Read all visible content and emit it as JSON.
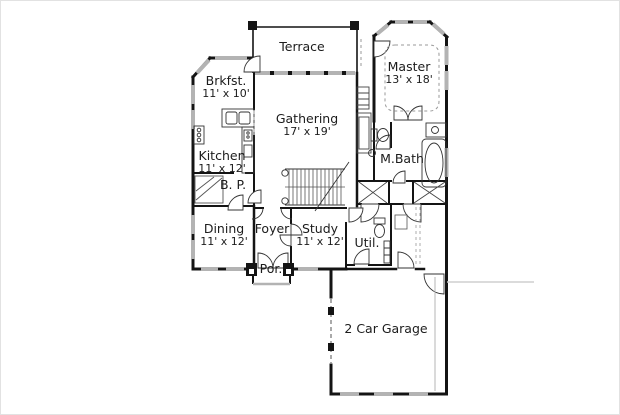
{
  "plan": {
    "type": "residential-floor-plan",
    "colors": {
      "wall": "#141414",
      "window": "#b3b3b3",
      "text": "#1c1c1c",
      "background": "#ffffff"
    }
  },
  "rooms": {
    "terrace": {
      "name": "Terrace"
    },
    "master": {
      "name": "Master",
      "dims": "13' x 18'"
    },
    "brkfst": {
      "name": "Brkfst.",
      "dims": "11' x 10'"
    },
    "gathering": {
      "name": "Gathering",
      "dims": "17' x 19'"
    },
    "kitchen": {
      "name": "Kitchen",
      "dims": "11' x 12'"
    },
    "butlers_pantry": {
      "name": "B. P."
    },
    "mbath": {
      "name": "M.Bath"
    },
    "dining": {
      "name": "Dining",
      "dims": "11' x 12'"
    },
    "foyer": {
      "name": "Foyer"
    },
    "study": {
      "name": "Study",
      "dims": "11' x 12'"
    },
    "utility": {
      "name": "Util."
    },
    "porch": {
      "name": "Por."
    },
    "garage": {
      "name": "2 Car Garage"
    }
  }
}
